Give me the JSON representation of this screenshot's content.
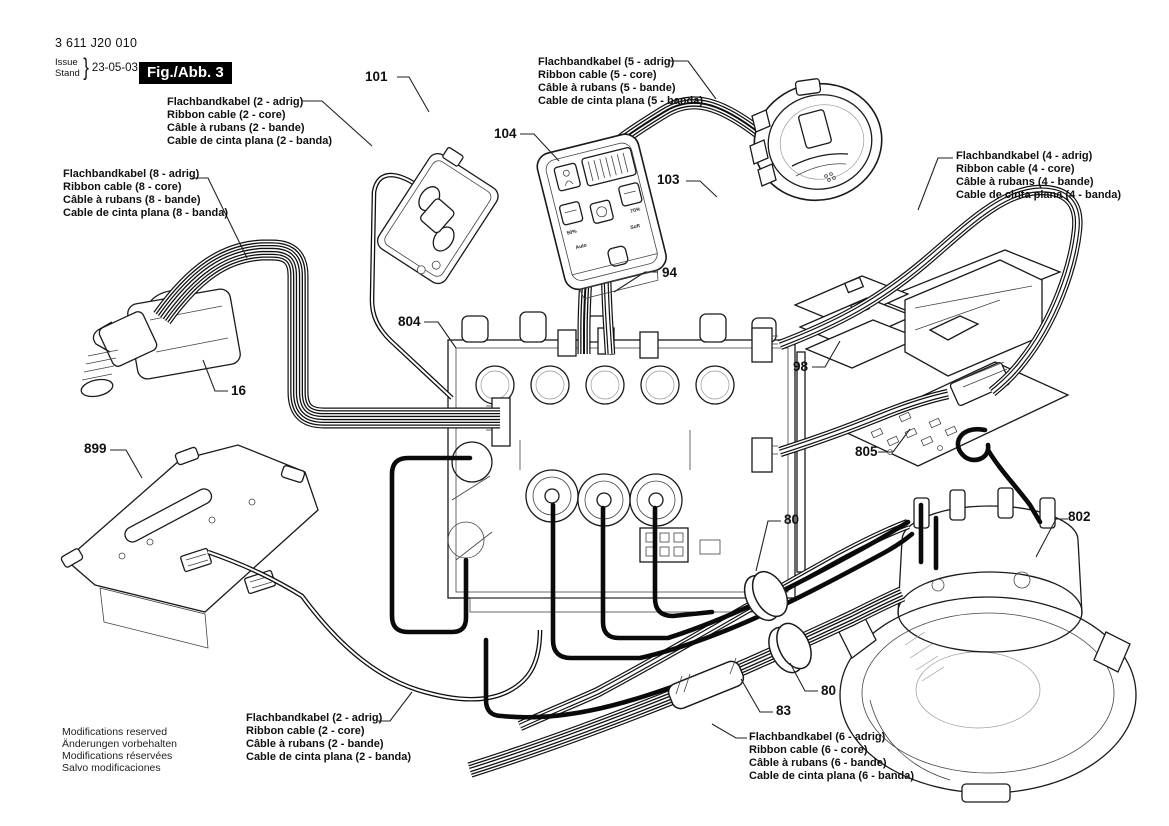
{
  "document": {
    "part_number": "3 611 J20 010",
    "issue_label": "Issue",
    "stand_label": "Stand",
    "brace": "}",
    "date": "23-05-03",
    "figure_title": "Fig./Abb. 3"
  },
  "labels": {
    "cable2_top": {
      "l1": "Flachbandkabel (2 - adrig)",
      "l2": "Ribbon cable (2 - core)",
      "l3": "Câble à rubans (2 - bande)",
      "l4": "Cable de cinta plana (2 - banda)"
    },
    "cable5": {
      "l1": "Flachbandkabel (5 - adrig)",
      "l2": "Ribbon cable (5 - core)",
      "l3": "Câble à rubans (5 - bande)",
      "l4": "Cable de cinta plana (5 - banda)"
    },
    "cable8": {
      "l1": "Flachbandkabel (8 - adrig)",
      "l2": "Ribbon cable (8 - core)",
      "l3": "Câble à rubans (8 - bande)",
      "l4": "Cable de cinta plana (8 - banda)"
    },
    "cable4": {
      "l1": "Flachbandkabel (4 - adrig)",
      "l2": "Ribbon cable (4 - core)",
      "l3": "Câble à rubans (4 - bande)",
      "l4": "Cable de cinta plana (4 - banda)"
    },
    "cable2_bottom": {
      "l1": "Flachbandkabel (2 - adrig)",
      "l2": "Ribbon cable (2 - core)",
      "l3": "Câble à rubans (2 - bande)",
      "l4": "Cable de cinta plana (2 - banda)"
    },
    "cable6": {
      "l1": "Flachbandkabel (6 - adrig)",
      "l2": "Ribbon cable (6 - core)",
      "l3": "Câble à rubans (6 - bande)",
      "l4": "Cable de cinta plana (6 - banda)"
    }
  },
  "callouts": {
    "c101": "101",
    "c104": "104",
    "c103": "103",
    "c94": "94",
    "c804": "804",
    "c16": "16",
    "c899": "899",
    "c98": "98",
    "c805": "805",
    "c80_upper": "80",
    "c802": "802",
    "c80_lower": "80",
    "c83": "83"
  },
  "control_panel": {
    "percent_50": "50%",
    "percent_70": "70%",
    "auto": "Auto",
    "soft": "Soft"
  },
  "footer": {
    "l1": "Modifications reserved",
    "l2": "Änderungen vorbehalten",
    "l3": "Modifications réservées",
    "l4": "Salvo modificaciones"
  }
}
